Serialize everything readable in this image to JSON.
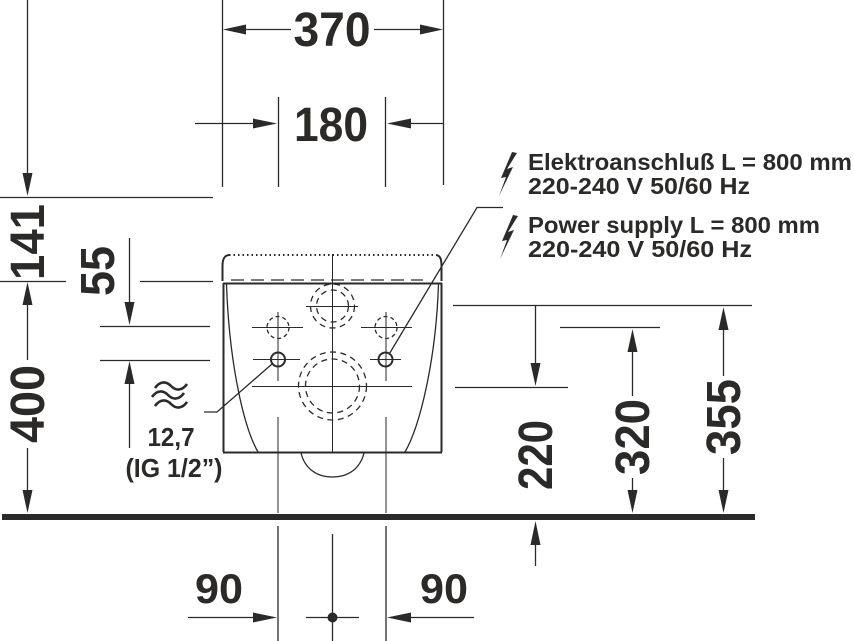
{
  "colors": {
    "ink": "#2b2a28",
    "background": "#ffffff"
  },
  "dims": {
    "overall_width": "370",
    "fixing_hole_spacing": "180",
    "top_edge_drop": "141",
    "hole_row_gap": "55",
    "body_top_height": "400",
    "outlet_center_height": "220",
    "fixing_holes_height": "320",
    "water_supply_height": "355",
    "bottom_offset_left": "90",
    "bottom_offset_right": "90"
  },
  "notes": {
    "electrical_de": {
      "line1": "Elektroanschluß L = 800 mm",
      "line2": "220-240 V  50/60 Hz"
    },
    "electrical_en": {
      "line1": "Power supply L = 800 mm",
      "line2": "220-240 V  50/60 Hz"
    },
    "water": {
      "size": "12,7",
      "thread": "(IG 1/2”)"
    }
  },
  "icons": {
    "electrical": "lightning-bolt",
    "water": "triple-wave"
  }
}
